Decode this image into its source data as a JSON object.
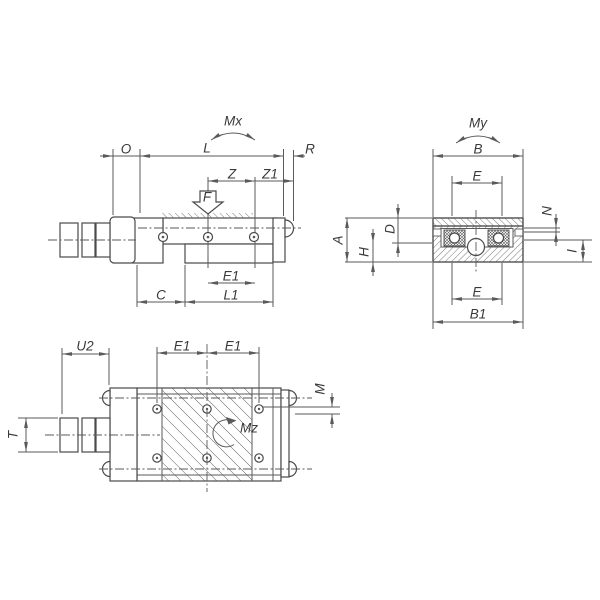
{
  "drawing": {
    "type": "engineering-dimension-drawing",
    "subject": "dovetail-slide-positioning-stage-with-micrometer",
    "background_color": "#ffffff",
    "line_color": "#4a4a4a",
    "label_color": "#3a3a3a",
    "side_view": {
      "moment_label": "Mx",
      "force_label": "F",
      "dim_o": "O",
      "dim_l": "L",
      "dim_r": "R",
      "dim_z": "Z",
      "dim_z1": "Z1",
      "dim_e1": "E1",
      "dim_c": "C",
      "dim_l1": "L1"
    },
    "section_view": {
      "moment_label": "My",
      "dim_b": "B",
      "dim_e_top": "E",
      "dim_a": "A",
      "dim_d": "D",
      "dim_h": "H",
      "dim_n": "N",
      "dim_i": "I",
      "dim_e_bottom": "E",
      "dim_b1": "B1"
    },
    "plan_view": {
      "moment_label": "Mz",
      "dim_u2": "U2",
      "dim_e1_left": "E1",
      "dim_e1_right": "E1",
      "dim_m": "M",
      "dim_t": "T"
    }
  }
}
